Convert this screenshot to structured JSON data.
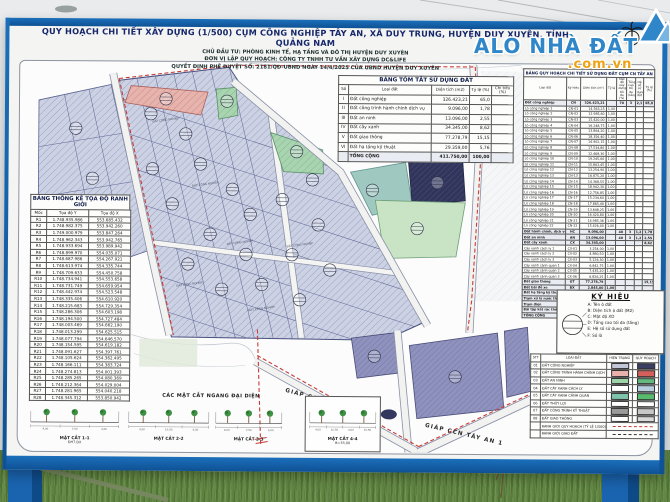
{
  "watermark": {
    "name": "ALO NHÀ ĐẤT",
    "domain": ".com.vn"
  },
  "board": {
    "title": "QUY HOẠCH CHI TIẾT XÂY DỰNG (1/500) CỤM CÔNG NGHIỆP TÂY AN, XÃ DUY TRUNG, HUYỆN DUY XUYÊN, TỈNH QUẢNG NAM",
    "subtitle1": "CHỦ ĐẦU TƯ: PHÒNG KINH TẾ, HẠ TẦNG VÀ ĐÔ THỊ HUYỆN DUY XUYÊN",
    "subtitle2": "ĐƠN VỊ LẬP QUY HOẠCH: CÔNG TY TNHH TƯ VẤN XÂY DỰNG DC&LIFE",
    "subtitle3": "QUYẾT ĐỊNH PHÊ DUYỆT SỐ: 2181/QĐ-UBND NGÀY 14/4/2025 CỦA UBND HUYỆN DUY XUYÊN"
  },
  "coord_table": {
    "title": "BẢNG THỐNG KÊ TỌA ĐỘ RANH GIỚI",
    "headers": [
      "Mốc",
      "Tọa độ Y",
      "Tọa độ X"
    ],
    "rows": [
      [
        "R1",
        "1.748.935.986",
        "553.685.432"
      ],
      [
        "R2",
        "1.748.982.375",
        "553.942.260"
      ],
      [
        "R3",
        "1.749.000.979",
        "553.847.264"
      ],
      [
        "R4",
        "1.748.962.343",
        "553.942.765"
      ],
      [
        "R5",
        "1.748.933.694",
        "553.989.942"
      ],
      [
        "R6",
        "1.748.899.970",
        "554.035.071"
      ],
      [
        "R7",
        "1.748.687.986",
        "554.267.921"
      ],
      [
        "R8",
        "1.748.613.974",
        "554.335.744"
      ],
      [
        "R9",
        "1.748.709.633",
        "554.450.758"
      ],
      [
        "R10",
        "1.748.734.941",
        "554.553.658"
      ],
      [
        "R11",
        "1.748.731.749",
        "554.659.954"
      ],
      [
        "R12",
        "1.748.442.974",
        "554.523.548"
      ],
      [
        "R13",
        "1.748.335.406",
        "554.610.920"
      ],
      [
        "R14",
        "1.748.215.683",
        "554.729.354"
      ],
      [
        "R15",
        "1.748.286.306",
        "554.603.198"
      ],
      [
        "R16",
        "1.748.194.500",
        "554.727.484"
      ],
      [
        "R17",
        "1.748.003.469",
        "554.662.190"
      ],
      [
        "R18",
        "1.748.013.299",
        "554.625.515"
      ],
      [
        "R19",
        "1.748.077.794",
        "554.646.570"
      ],
      [
        "R20",
        "1.748.154.595",
        "554.619.182"
      ],
      [
        "R21",
        "1.748.091.627",
        "554.397.761"
      ],
      [
        "R22",
        "1.748.105.624",
        "554.362.495"
      ],
      [
        "R23",
        "1.748.166.111",
        "554.383.724"
      ],
      [
        "R24",
        "1.748.274.813",
        "554.001.393"
      ],
      [
        "R25",
        "1.748.285.265",
        "554.080.369"
      ],
      [
        "R26",
        "1.748.212.364",
        "554.029.004"
      ],
      [
        "R27",
        "1.748.281.965",
        "554.040.218"
      ],
      [
        "R28",
        "1.748.345.312",
        "553.850.942"
      ]
    ]
  },
  "summary_table": {
    "title": "BẢNG TÓM TẮT SỬ DỤNG ĐẤT",
    "headers": [
      "Số",
      "Loại đất",
      "Diện tích (m2)",
      "Tỷ lệ (%)",
      "Chỉ tiêu (%)"
    ],
    "rows": [
      [
        "I",
        "Đất công nghiệp",
        "326.423,21",
        "65,0",
        ""
      ],
      [
        "II",
        "Đất công trình hành chính dịch vụ",
        "9.096,00",
        "1,78",
        ""
      ],
      [
        "III",
        "Đất an ninh",
        "13.096,00",
        "2,55",
        ""
      ],
      [
        "IV",
        "Đất cây xanh",
        "34.345,00",
        "8,62",
        ""
      ],
      [
        "V",
        "Đất giao thông",
        "77.278,79",
        "15,15",
        ""
      ],
      [
        "VI",
        "Đất hạ tầng kỹ thuật",
        "29.359,00",
        "5,76",
        ""
      ],
      [
        "",
        "TỔNG CỘNG",
        "411.750,00",
        "100,00",
        ""
      ]
    ]
  },
  "detail_table": {
    "title": "BẢNG QUY HOẠCH CHI TIẾT SỬ DỤNG ĐẤT CỤM CN TÂY AN",
    "headers": [
      "Loại đất",
      "Ký hiệu",
      "Diện tích (m²)",
      "Tỷ lệ",
      "Mật độ xây dựng tối đa (%)",
      "Tầng cao tối đa (tầng)",
      "Hệ số sử dụng đất",
      "Tỷ lệ (%)"
    ],
    "rows": [
      [
        "Đất công nghiệp",
        "CN",
        "326.423,21",
        "",
        "70",
        "3",
        "2,1",
        "65,0"
      ],
      [
        "Lô công nghiệp 1",
        "CN-01",
        "14.563,25",
        "1,00",
        "",
        "",
        "",
        ""
      ],
      [
        "Lô công nghiệp 2",
        "CN-02",
        "12.985,60",
        "1,00",
        "",
        "",
        "",
        ""
      ],
      [
        "Lô công nghiệp 3",
        "CN-03",
        "15.420,00",
        "1,00",
        "",
        "",
        "",
        ""
      ],
      [
        "Lô công nghiệp 4",
        "CN-04",
        "16.248,75",
        "1,00",
        "",
        "",
        "",
        ""
      ],
      [
        "Lô công nghiệp 5",
        "CN-05",
        "13.864,20",
        "1,00",
        "",
        "",
        "",
        ""
      ],
      [
        "Lô công nghiệp 6",
        "CN-06",
        "18.356,40",
        "1,00",
        "",
        "",
        "",
        ""
      ],
      [
        "Lô công nghiệp 7",
        "CN-07",
        "14.902,15",
        "1,00",
        "",
        "",
        "",
        ""
      ],
      [
        "Lô công nghiệp 8",
        "CN-08",
        "17.534,80",
        "1,00",
        "",
        "",
        "",
        ""
      ],
      [
        "Lô công nghiệp 9",
        "CN-09",
        "12.468,30",
        "1,00",
        "",
        "",
        "",
        ""
      ],
      [
        "Lô công nghiệp 10",
        "CN-10",
        "19.245,60",
        "1,00",
        "",
        "",
        "",
        ""
      ],
      [
        "Lô công nghiệp 11",
        "CN-11",
        "15.863,45",
        "1,00",
        "",
        "",
        "",
        ""
      ],
      [
        "Lô công nghiệp 12",
        "CN-12",
        "13.254,90",
        "1,00",
        "",
        "",
        "",
        ""
      ],
      [
        "Lô công nghiệp 13",
        "CN-13",
        "16.875,20",
        "1,00",
        "",
        "",
        "",
        ""
      ],
      [
        "Lô công nghiệp 14",
        "CN-14",
        "14.368,55",
        "1,00",
        "",
        "",
        "",
        ""
      ],
      [
        "Lô công nghiệp 15",
        "CN-15",
        "18.942,30",
        "1,00",
        "",
        "",
        "",
        ""
      ],
      [
        "Lô công nghiệp 16",
        "CN-16",
        "12.756,85",
        "1,00",
        "",
        "",
        "",
        ""
      ],
      [
        "Lô công nghiệp 17",
        "CN-17",
        "15.234,60",
        "1,00",
        "",
        "",
        "",
        ""
      ],
      [
        "Lô công nghiệp 18",
        "CN-18",
        "17.865,40",
        "1,00",
        "",
        "",
        "",
        ""
      ],
      [
        "Lô công nghiệp 19",
        "CN-19",
        "13.648,25",
        "1,00",
        "",
        "",
        "",
        ""
      ],
      [
        "Lô công nghiệp 20",
        "CN-20",
        "16.420,80",
        "1,00",
        "",
        "",
        "",
        ""
      ],
      [
        "Lô công nghiệp 21",
        "CN-21",
        "14.985,36",
        "1,00",
        "",
        "",
        "",
        ""
      ],
      [
        "Lô công nghiệp 22",
        "CN-22",
        "15.426,00",
        "1,00",
        "",
        "",
        "",
        ""
      ],
      [
        "Đất hành chính, dịch vụ",
        "HC",
        "9.096,00",
        "",
        "40",
        "3",
        "1,2",
        "1,78"
      ],
      [
        "Đất an ninh",
        "AN",
        "13.096,00",
        "",
        "40",
        "3",
        "1,2",
        "2,55"
      ],
      [
        "Đất cây xanh",
        "CX",
        "34.345,00",
        "",
        "",
        "",
        "",
        "8,62"
      ],
      [
        "Cây xanh cách ly 1",
        "CX-01",
        "3.254,00",
        "1,00",
        "",
        "",
        "",
        ""
      ],
      [
        "Cây xanh cách ly 2",
        "CX-02",
        "4.860,50",
        "1,00",
        "",
        "",
        "",
        ""
      ],
      [
        "Cây xanh cách ly 3",
        "CX-03",
        "5.126,30",
        "1,00",
        "",
        "",
        "",
        ""
      ],
      [
        "Cây xanh cảnh quan 1",
        "CX-04",
        "6.842,75",
        "1,00",
        "",
        "",
        "",
        ""
      ],
      [
        "Cây xanh cảnh quan 2",
        "CX-05",
        "7.435,20",
        "1,00",
        "",
        "",
        "",
        ""
      ],
      [
        "Cây xanh cảnh quan 3",
        "CX-06",
        "6.826,25",
        "1,00",
        "",
        "",
        "",
        ""
      ],
      [
        "Đất giao thông",
        "GT",
        "77.278,79",
        "",
        "",
        "",
        "",
        "15,15"
      ],
      [
        "Đất bãi đỗ xe",
        "BX",
        "2.845,00",
        "1,00",
        "",
        "",
        "",
        ""
      ],
      [
        "Đất hạ tầng kỹ thuật",
        "KT",
        "29.359,00",
        "",
        "",
        "",
        "",
        "5,76"
      ],
      [
        "Trạm xử lý nước thải",
        "XLNT",
        "15.680,00",
        "1,00",
        "",
        "",
        "",
        ""
      ],
      [
        "Trạm điện",
        "TĐ",
        "1.250,00",
        "1,00",
        "",
        "",
        "",
        ""
      ],
      [
        "Bãi tập kết rác thải",
        "BR",
        "2.420,00",
        "1,00",
        "",
        "",
        "",
        ""
      ],
      [
        "TỔNG CỘNG",
        "",
        "411.750,00",
        "",
        "",
        "",
        "",
        "100,00"
      ]
    ]
  },
  "symbol_legend": {
    "title": "KÝ HIỆU",
    "items": [
      "A: Tên ô đất",
      "B: Diện tích ô đất (M2)",
      "C: Mật độ XD",
      "D: Tầng cao tối đa (tầng)",
      "E: Hệ số sử dụng đất",
      "F: Số lô"
    ]
  },
  "color_legend": {
    "headers": [
      "STT",
      "LOẠI ĐẤT",
      "HIỆN TRẠNG",
      "QUY HOẠCH"
    ],
    "rows": [
      {
        "stt": "01",
        "label": "ĐẤT CÔNG NGHIỆP",
        "ht": "#c2c6d6",
        "qh": "#3a3e63"
      },
      {
        "stt": "02",
        "label": "ĐẤT CÔNG TRÌNH HÀNH CHÍNH DỊCH VỤ",
        "ht": "#e9b0ac",
        "qh": "#d4605c"
      },
      {
        "stt": "03",
        "label": "ĐẤT AN NINH",
        "ht": "#9ed3aa",
        "qh": "#63b97e"
      },
      {
        "stt": "04",
        "label": "ĐẤT CÂY XANH CÁCH LY",
        "ht": "",
        "qh": "#b8cfe0"
      },
      {
        "stt": "05",
        "label": "ĐẤT CÂY XANH CẢNH QUAN",
        "ht": "#7ec4ad",
        "qh": "#58bb6e"
      },
      {
        "stt": "06",
        "label": "ĐẤT THỦY LỢI",
        "ht": "",
        "qh": "#ffffff"
      },
      {
        "stt": "07",
        "label": "ĐẤT CÔNG TRÌNH KỸ THUẬT",
        "ht": "#9a9a9a",
        "qh": "#c8c8c8"
      },
      {
        "stt": "08",
        "label": "ĐẤT GIAO THÔNG",
        "ht": "#ffffff",
        "qh": "#d9d9d9"
      },
      {
        "stt": "",
        "label": "RANH GIỚI QUY HOẠCH (TỶ LỆ 1/500)",
        "line": "red-dash"
      },
      {
        "stt": "",
        "label": "RANH GIỚI GIAO ĐẤT",
        "line": "black-dash"
      }
    ]
  },
  "cross_sections": {
    "title": "CÁC MẶT CẮT NGANG ĐẠI DIỆN",
    "items": [
      {
        "label": "MẶT CẮT 1-1",
        "sub": "ĐH7.ĐX",
        "dims": [
          "4,00",
          "7,50",
          "4,00"
        ]
      },
      {
        "label": "MẶT CẮT 2-2",
        "sub": "",
        "dims": [
          "4,00",
          "10,50",
          "4,00"
        ]
      },
      {
        "label": "MẶT CẮT 3-3",
        "sub": "",
        "dims": [
          "4,00",
          "7,50",
          "4,00"
        ]
      },
      {
        "label": "MẶT CẮT 4-4",
        "sub": "B=33,00",
        "dims": [
          "4,00",
          "10,50",
          "4,00",
          "10,50"
        ]
      }
    ]
  },
  "map": {
    "plot_caption": "ĐẤT CÔNG NGHIỆP",
    "road_labels": [
      {
        "text": "GIÁP CCN TÂY AN 1",
        "x": 286,
        "y": 392,
        "rot": 15
      },
      {
        "text": "GIÁP CCN TÂY AN 1",
        "x": 426,
        "y": 426,
        "rot": 13
      }
    ],
    "lot_markers": [
      [
        150,
        115
      ],
      [
        185,
        135
      ],
      [
        152,
        170
      ],
      [
        200,
        165
      ],
      [
        232,
        190
      ],
      [
        172,
        205
      ],
      [
        210,
        235
      ],
      [
        250,
        215
      ],
      [
        246,
        255
      ],
      [
        188,
        265
      ],
      [
        222,
        290
      ],
      [
        262,
        285
      ],
      [
        292,
        255
      ],
      [
        300,
        300
      ],
      [
        318,
        225
      ],
      [
        330,
        270
      ],
      [
        282,
        200
      ],
      [
        312,
        180
      ],
      [
        75,
        130
      ],
      [
        92,
        180
      ],
      [
        165,
        100
      ],
      [
        226,
        102
      ],
      [
        296,
        152
      ],
      [
        437,
        182
      ],
      [
        417,
        228
      ],
      [
        372,
        190
      ],
      [
        375,
        356
      ],
      [
        456,
        376
      ]
    ],
    "caption_spots": [
      [
        165,
        112
      ],
      [
        205,
        176
      ],
      [
        240,
        234
      ],
      [
        190,
        276
      ],
      [
        300,
        236
      ],
      [
        262,
        300
      ]
    ]
  }
}
